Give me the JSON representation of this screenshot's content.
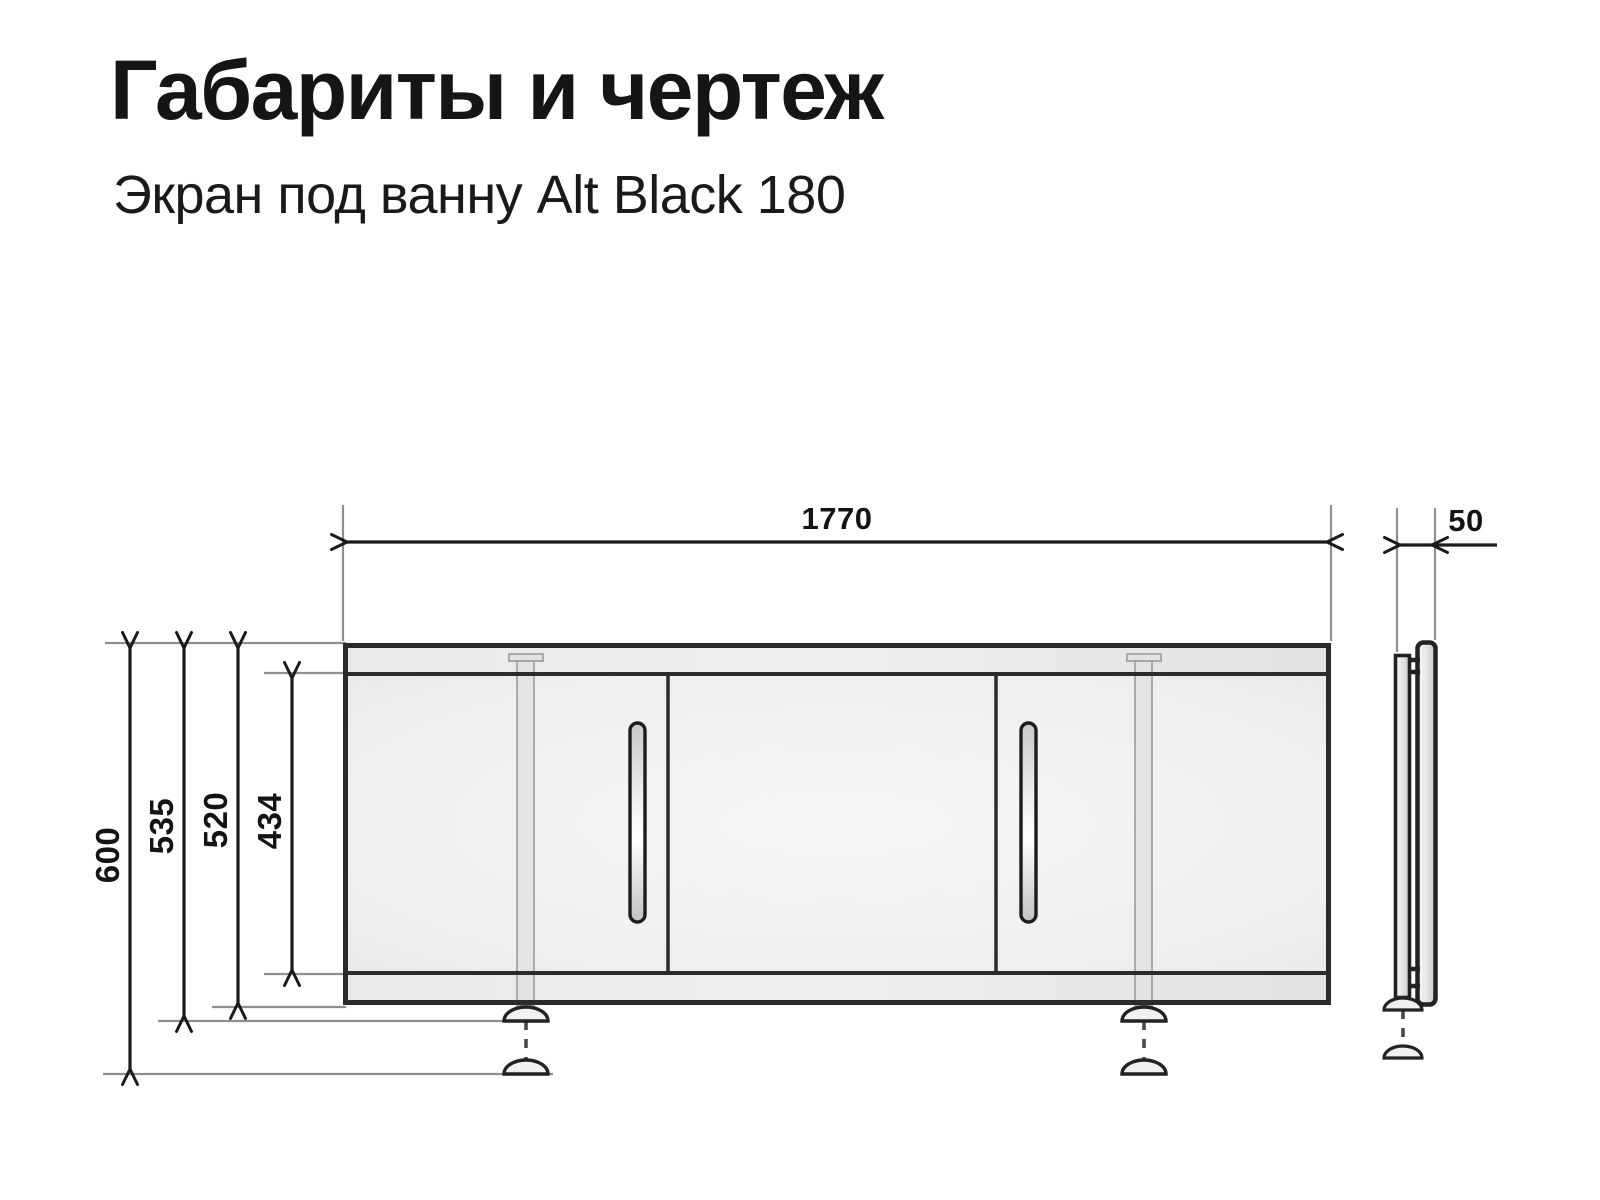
{
  "header": {
    "title": "Габариты и чертеж",
    "subtitle": "Экран под ванну Alt Black 180"
  },
  "dims": {
    "width": "1770",
    "depth": "50",
    "height_overall": "600",
    "height_with_feet": "535",
    "height_panel": "520",
    "height_inner": "434"
  },
  "colors": {
    "ink": "#1b1b1b",
    "outline": "#2b2b2b",
    "extension_line": "#8f8f8f",
    "panel_fill": "#f2f2f2",
    "rail_fill": "#e7e7e7"
  }
}
